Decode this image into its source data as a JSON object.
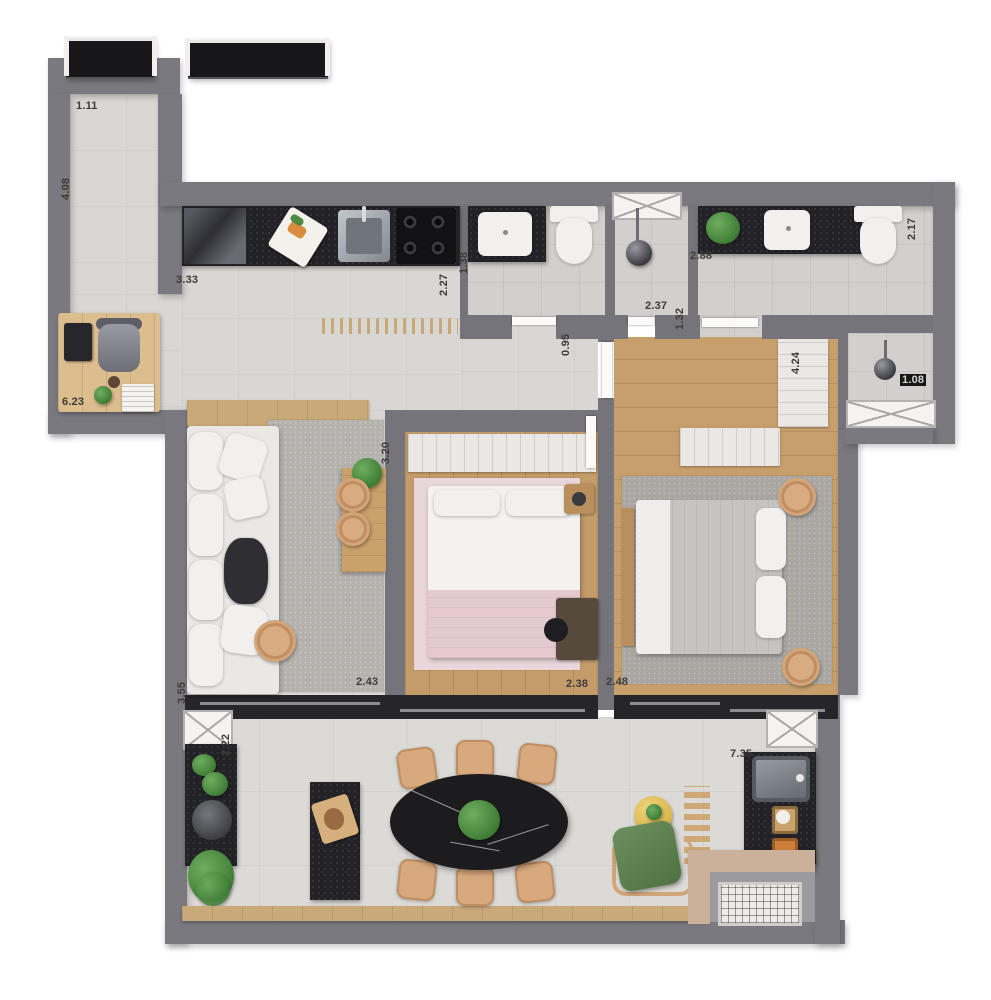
{
  "plan_title": "apartment-floor-plan",
  "dimensions": {
    "corridor_top": "1.11",
    "corridor_side": "4.08",
    "kitchen_length": "3.33",
    "kitchen_depth": "2.27",
    "bath_social_width": "1.38",
    "shower_box_width": "2.37",
    "bedroom3_door": "0.95",
    "bath_suite_length": "2.88",
    "bath_suite_door": "1.32",
    "bath_suite_depth": "2.17",
    "shower_suite_width": "1.08",
    "office_living_length": "6.23",
    "bedroom2_depth": "3.20",
    "wardrobe_bedroom3_length": "4.24",
    "living_depth": "3.55",
    "living_door_width": "2.43",
    "bedroom2_width": "2.38",
    "bedroom3_width": "2.48",
    "terrace_depth": "2.22",
    "terrace_width": "7.35"
  },
  "colors": {
    "wall": "#7a797f",
    "tile_floor": "#d9d7d3",
    "wood_floor": "#c79f6d",
    "dark_counter": "#232327",
    "rug_pink": "#e9d6da",
    "rug_gray": "#aaa7a3",
    "plant_green": "#3c7a33",
    "chair_tan": "#d9a97e",
    "armchair_green": "#5d8050",
    "side_table_yellow": "#e3c35f"
  }
}
